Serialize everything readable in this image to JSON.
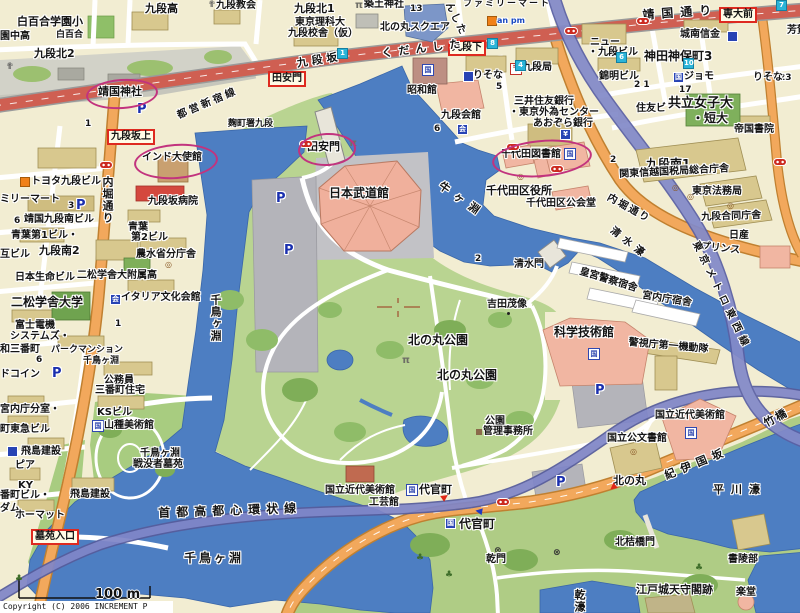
{
  "meta": {
    "copyright": "Copyright (C) 2006 INCREMENT P CORP.",
    "scale_label": "100 m"
  },
  "colors": {
    "water": "#4D7EC2",
    "park_green": "#B9D491",
    "dark_green": "#7FAE58",
    "block_cream": "#F2EDD2",
    "building_tan": "#D8C88E",
    "building_pink": "#F1B6A2",
    "building_red": "#D4483E",
    "road_orange": "#F2A85C",
    "road_red": "#CF5F52",
    "expressway_purple": "#8086C8",
    "annotation_magenta": "#C2337E",
    "station_box_red": "#DE2A20",
    "parking_blue": "#1A2FAE"
  },
  "map": {
    "annotations": [
      {
        "x": 86,
        "y": 79,
        "w": 68,
        "h": 26,
        "r": -4,
        "n": "annotation-yasukuni-shrine"
      },
      {
        "x": 134,
        "y": 144,
        "w": 80,
        "h": 31,
        "r": -4,
        "n": "annotation-india-embassy"
      },
      {
        "x": 298,
        "y": 133,
        "w": 54,
        "h": 29,
        "r": -3,
        "n": "annotation-tayasumon"
      },
      {
        "x": 492,
        "y": 140,
        "w": 96,
        "h": 33,
        "r": -5,
        "n": "annotation-chiyoda-library"
      }
    ],
    "labels": [
      {
        "t": "白百合学園小",
        "x": 17,
        "y": 16,
        "c": "s11"
      },
      {
        "t": "園中高",
        "x": 0,
        "y": 32
      },
      {
        "t": "白百合",
        "x": 56,
        "y": 31,
        "c": "s9"
      },
      {
        "t": "九段北2",
        "x": 34,
        "y": 48,
        "c": "s11"
      },
      {
        "t": "九段高",
        "x": 145,
        "y": 3,
        "c": "s11"
      },
      {
        "t": "✟",
        "x": 208,
        "y": 1,
        "c": "church"
      },
      {
        "t": "九段教会",
        "x": 216,
        "y": 1
      },
      {
        "t": "✟",
        "x": 6,
        "y": 63,
        "c": "church"
      },
      {
        "t": "九段北1",
        "x": 294,
        "y": 3,
        "c": "s11"
      },
      {
        "t": "π",
        "x": 355,
        "y": 1,
        "c": "torii"
      },
      {
        "t": "築土神社",
        "x": 364,
        "y": 0
      },
      {
        "t": "13",
        "x": 410,
        "y": 5,
        "c": "s9"
      },
      {
        "t": "東京理科大",
        "x": 295,
        "y": 18
      },
      {
        "t": "九段校舎（仮）",
        "x": 288,
        "y": 29
      },
      {
        "t": "北の丸スクエア",
        "x": 380,
        "y": 23
      },
      {
        "t": "ファミリーマート",
        "x": 463,
        "y": 0,
        "c": "s9",
        "ls": 2
      },
      {
        "t": "",
        "x": 487,
        "y": 16,
        "c": "sqo"
      },
      {
        "t": "an pm",
        "x": 497,
        "y": 17,
        "c": "ampm"
      },
      {
        "t": "靖国通り",
        "x": 642,
        "y": 9,
        "c": "s12",
        "ls": 7,
        "r": -4,
        "n": "yasukuni-dori-label"
      },
      {
        "t": "",
        "x": 637,
        "y": 18,
        "c": "bus"
      },
      {
        "t": "専大前",
        "x": 719,
        "y": 7,
        "c": "rbox",
        "n": "sendaimae-stop-box"
      },
      {
        "t": "芳賀",
        "x": 787,
        "y": 26
      },
      {
        "t": "城南信金",
        "x": 680,
        "y": 30
      },
      {
        "t": "",
        "x": 727,
        "y": 31,
        "c": "sqb"
      },
      {
        "t": "ニュー",
        "x": 590,
        "y": 38
      },
      {
        "t": "・九段ビル",
        "x": 588,
        "y": 48
      },
      {
        "t": "神田神保町3",
        "x": 644,
        "y": 50,
        "c": "s12"
      },
      {
        "t": "錦明ビル",
        "x": 599,
        "y": 72
      },
      {
        "t": "2 1",
        "x": 634,
        "y": 81,
        "c": "s9"
      },
      {
        "t": "国",
        "x": 673,
        "y": 72,
        "c": "sqb"
      },
      {
        "t": "ジョモ",
        "x": 684,
        "y": 72
      },
      {
        "t": "17",
        "x": 679,
        "y": 86,
        "c": "s9"
      },
      {
        "t": "23",
        "x": 779,
        "y": 74,
        "c": "s9"
      },
      {
        "t": "りそな",
        "x": 753,
        "y": 73
      },
      {
        "t": "住友ビ",
        "x": 636,
        "y": 104
      },
      {
        "t": "共立女子大",
        "x": 668,
        "y": 97,
        "c": "s13"
      },
      {
        "t": "・短大",
        "x": 692,
        "y": 112,
        "c": "s12"
      },
      {
        "t": "帝国書院",
        "x": 734,
        "y": 125
      },
      {
        "t": "九段南1",
        "x": 646,
        "y": 158,
        "c": "s12"
      },
      {
        "t": "2",
        "x": 610,
        "y": 156,
        "c": "s9"
      },
      {
        "t": "関東信越国税局総合庁舎",
        "x": 619,
        "y": 170,
        "r": -3
      },
      {
        "t": "東京法務局",
        "x": 692,
        "y": 187
      },
      {
        "t": "九段合同庁舎",
        "x": 701,
        "y": 213,
        "r": -2
      },
      {
        "t": "日産",
        "x": 729,
        "y": 231
      },
      {
        "t": "プリンス",
        "x": 701,
        "y": 242,
        "r": 6
      },
      {
        "t": "内堀通り",
        "x": 610,
        "y": 193,
        "r": 29,
        "ls": 2,
        "n": "uchibori-dori-label"
      },
      {
        "t": "清水濠",
        "x": 614,
        "y": 226,
        "r": 38,
        "ls": 5,
        "n": "shimizubori-label"
      },
      {
        "t": "東京メトロ東西線",
        "x": 699,
        "y": 240,
        "r": 64,
        "ls": 5,
        "n": "tozai-line-label"
      },
      {
        "t": "んした",
        "x": 452,
        "y": 1,
        "r": 64,
        "ls": 2
      },
      {
        "t": "九段下",
        "x": 448,
        "y": 40,
        "c": "rbox",
        "n": "kudanshita-box"
      },
      {
        "t": "くだんした",
        "x": 381,
        "y": 48,
        "c": "s11",
        "ls": 6,
        "r": -7
      },
      {
        "t": "九段坂",
        "x": 296,
        "y": 58,
        "c": "s11",
        "ls": 4,
        "r": -9,
        "n": "kudanzaka-label"
      },
      {
        "t": "都営新宿線",
        "x": 176,
        "y": 112,
        "ls": 3,
        "r": -23,
        "n": "toei-shinjuku-line-label"
      },
      {
        "t": "靖国神社",
        "x": 98,
        "y": 86,
        "c": "s11",
        "n": "yasukuni-shrine-label"
      },
      {
        "t": "P",
        "x": 137,
        "y": 103,
        "c": "p"
      },
      {
        "t": "1",
        "x": 85,
        "y": 120,
        "c": "s9"
      },
      {
        "t": "九段坂上",
        "x": 107,
        "y": 129,
        "c": "rbox",
        "n": "kudanzakaue-box"
      },
      {
        "t": "麹町署九段",
        "x": 228,
        "y": 120,
        "c": "s9"
      },
      {
        "t": "田安門",
        "x": 268,
        "y": 71,
        "c": "rbox",
        "n": "tayasumon-stop-box"
      },
      {
        "t": "インド大使館",
        "x": 142,
        "y": 153,
        "n": "india-embassy-label"
      },
      {
        "t": "",
        "x": 20,
        "y": 177,
        "c": "sqo"
      },
      {
        "t": "トヨタ九段ビル",
        "x": 31,
        "y": 177
      },
      {
        "t": "ミリーマート",
        "x": 0,
        "y": 195
      },
      {
        "t": "3",
        "x": 68,
        "y": 202,
        "c": "s9"
      },
      {
        "t": "P",
        "x": 76,
        "y": 199,
        "c": "p"
      },
      {
        "t": "6",
        "x": 14,
        "y": 217,
        "c": "s9"
      },
      {
        "t": "靖国九段南ビル",
        "x": 24,
        "y": 215
      },
      {
        "t": "青葉第1ビル・",
        "x": 11,
        "y": 231
      },
      {
        "t": "互ビル",
        "x": 0,
        "y": 250
      },
      {
        "t": "九段南2",
        "x": 39,
        "y": 245,
        "c": "s11"
      },
      {
        "t": "九段坂病院",
        "x": 148,
        "y": 197
      },
      {
        "t": "青葉",
        "x": 128,
        "y": 223
      },
      {
        "t": "第2ビル",
        "x": 131,
        "y": 233
      },
      {
        "t": "農水省分庁舎",
        "x": 136,
        "y": 250
      },
      {
        "t": "◎",
        "x": 165,
        "y": 261,
        "c": "gov"
      },
      {
        "t": "内堀通り",
        "x": 102,
        "y": 176,
        "c": "vert s11",
        "n": "uchibori-dori-west-label"
      },
      {
        "t": "日本生命ビル",
        "x": 15,
        "y": 273
      },
      {
        "t": "二松学舎大附属高",
        "x": 77,
        "y": 271
      },
      {
        "t": "二松学舎大学",
        "x": 11,
        "y": 296,
        "c": "s12"
      },
      {
        "t": "会",
        "x": 110,
        "y": 294,
        "c": "sqb"
      },
      {
        "t": "イタリア文化会館",
        "x": 121,
        "y": 293
      },
      {
        "t": "1",
        "x": 115,
        "y": 320,
        "c": "s9"
      },
      {
        "t": "富士電機",
        "x": 15,
        "y": 321
      },
      {
        "t": "システムズ・",
        "x": 10,
        "y": 332
      },
      {
        "t": "和三番町",
        "x": 0,
        "y": 345
      },
      {
        "t": "6",
        "x": 36,
        "y": 356,
        "c": "s9"
      },
      {
        "t": "パークマンション",
        "x": 51,
        "y": 346,
        "c": "s9"
      },
      {
        "t": "千鳥ヶ淵",
        "x": 83,
        "y": 357,
        "c": "s9"
      },
      {
        "t": "ドコイン",
        "x": 0,
        "y": 370
      },
      {
        "t": "P",
        "x": 52,
        "y": 367,
        "c": "p"
      },
      {
        "t": "公務員",
        "x": 104,
        "y": 376
      },
      {
        "t": "三番町住宅",
        "x": 95,
        "y": 386
      },
      {
        "t": "宮内庁分室・",
        "x": 0,
        "y": 405
      },
      {
        "t": "町東急ビル",
        "x": 0,
        "y": 425
      },
      {
        "t": "KSビル",
        "x": 97,
        "y": 408
      },
      {
        "t": "国",
        "x": 92,
        "y": 420,
        "c": "mus"
      },
      {
        "t": "山種美術館",
        "x": 104,
        "y": 421
      },
      {
        "t": "",
        "x": 7,
        "y": 446,
        "c": "sqb"
      },
      {
        "t": "飛島建設",
        "x": 21,
        "y": 447
      },
      {
        "t": "ピア",
        "x": 15,
        "y": 461
      },
      {
        "t": "千鳥ヶ淵",
        "x": 140,
        "y": 449
      },
      {
        "t": "戦没者墓苑",
        "x": 133,
        "y": 460
      },
      {
        "t": "KY",
        "x": 18,
        "y": 481
      },
      {
        "t": "番町ビル・",
        "x": 0,
        "y": 491
      },
      {
        "t": "ダム",
        "x": 0,
        "y": 504
      },
      {
        "t": "飛島建設",
        "x": 70,
        "y": 490
      },
      {
        "t": "ホーマット",
        "x": 15,
        "y": 511
      },
      {
        "t": "墓苑入口",
        "x": 31,
        "y": 529,
        "c": "rbox",
        "n": "cemetery-entrance-box"
      },
      {
        "t": "♣",
        "x": 15,
        "y": 575,
        "c": "tree"
      },
      {
        "t": "首都高都心環状線",
        "x": 158,
        "y": 507,
        "c": "s12",
        "ls": 6,
        "r": -2,
        "n": "shuto-expressway-label"
      },
      {
        "t": "千鳥ヶ淵",
        "x": 184,
        "y": 552,
        "c": "s12",
        "ls": 3,
        "n": "chidorigafuchi-label"
      },
      {
        "t": "千鳥ヶ淵",
        "x": 210,
        "y": 294,
        "c": "vert s11",
        "n": "chidorigafuchi-moat-label"
      },
      {
        "t": "π",
        "x": 349,
        "y": 139,
        "c": "torii"
      },
      {
        "t": "田安門",
        "x": 307,
        "y": 141,
        "c": "s11",
        "n": "tayasumon-label"
      },
      {
        "t": "日本武道館",
        "x": 329,
        "y": 187,
        "c": "s12",
        "n": "budokan-label"
      },
      {
        "t": "P",
        "x": 276,
        "y": 192,
        "c": "p"
      },
      {
        "t": "P",
        "x": 284,
        "y": 244,
        "c": "p"
      },
      {
        "t": "昭和館",
        "x": 407,
        "y": 86
      },
      {
        "t": "国",
        "x": 422,
        "y": 64,
        "c": "mus"
      },
      {
        "t": "九段会館",
        "x": 441,
        "y": 111
      },
      {
        "t": "6",
        "x": 434,
        "y": 125,
        "c": "s9"
      },
      {
        "t": "会",
        "x": 457,
        "y": 124,
        "c": "sqb"
      },
      {
        "t": "りそな",
        "x": 473,
        "y": 71
      },
      {
        "t": "",
        "x": 463,
        "y": 71,
        "c": "sqb"
      },
      {
        "t": "5",
        "x": 496,
        "y": 83,
        "c": "s9"
      },
      {
        "t": "〒",
        "x": 510,
        "y": 63,
        "c": "post"
      },
      {
        "t": "九段局",
        "x": 522,
        "y": 63
      },
      {
        "t": "三井住友銀行",
        "x": 514,
        "y": 97
      },
      {
        "t": "・東京外為センター",
        "x": 509,
        "y": 108
      },
      {
        "t": "あおぞら銀行",
        "x": 533,
        "y": 119
      },
      {
        "t": "¥",
        "x": 560,
        "y": 129,
        "c": "sqb"
      },
      {
        "t": "千代田図書館",
        "x": 501,
        "y": 150,
        "n": "chiyoda-library-label"
      },
      {
        "t": "国",
        "x": 564,
        "y": 148,
        "c": "mus"
      },
      {
        "t": "◎",
        "x": 517,
        "y": 173,
        "c": "gov"
      },
      {
        "t": "千代田区役所",
        "x": 486,
        "y": 185,
        "c": "s11",
        "n": "chiyoda-ward-office-label"
      },
      {
        "t": "千代田区公会堂",
        "x": 526,
        "y": 199
      },
      {
        "t": "牛ヶ淵",
        "x": 443,
        "y": 180,
        "c": "s11",
        "ls": 7,
        "r": 35,
        "n": "ushigafuchi-label"
      },
      {
        "t": "清水門",
        "x": 514,
        "y": 260,
        "n": "shimizumon-label"
      },
      {
        "t": "2",
        "x": 475,
        "y": 255,
        "c": "s9"
      },
      {
        "t": "皇宮警察宿舎",
        "x": 581,
        "y": 267,
        "r": 17
      },
      {
        "t": "宮内庁宿舎",
        "x": 643,
        "y": 291,
        "r": 9
      },
      {
        "t": "警視庁第一機動隊",
        "x": 629,
        "y": 338,
        "r": 5
      },
      {
        "t": "吉田茂像",
        "x": 487,
        "y": 300
      },
      {
        "t": "",
        "x": 507,
        "y": 312,
        "c": "dotb"
      },
      {
        "t": "北の丸公園",
        "x": 408,
        "y": 334,
        "c": "s12",
        "n": "kitanomaru-park-label"
      },
      {
        "t": "北の丸公園",
        "x": 437,
        "y": 369,
        "c": "s12",
        "n": "kitanomaru-park-label-2"
      },
      {
        "t": "π",
        "x": 402,
        "y": 356,
        "c": "torii"
      },
      {
        "t": "科学技術館",
        "x": 554,
        "y": 326,
        "c": "s12",
        "n": "science-museum-label"
      },
      {
        "t": "国",
        "x": 588,
        "y": 348,
        "c": "mus"
      },
      {
        "t": "P",
        "x": 595,
        "y": 384,
        "c": "p"
      },
      {
        "t": "公園",
        "x": 485,
        "y": 417
      },
      {
        "t": "管理事務所",
        "x": 483,
        "y": 427
      },
      {
        "t": "",
        "x": 476,
        "y": 429,
        "c": "hut"
      },
      {
        "t": "国立近代美術館",
        "x": 325,
        "y": 486
      },
      {
        "t": "工芸館",
        "x": 369,
        "y": 498
      },
      {
        "t": "国",
        "x": 406,
        "y": 484,
        "c": "mus"
      },
      {
        "t": "代官町",
        "x": 419,
        "y": 484,
        "c": "s11"
      },
      {
        "t": "▶",
        "x": 440,
        "y": 496,
        "c": "arrR",
        "r": -35
      },
      {
        "t": "◀",
        "x": 476,
        "y": 507,
        "c": "arrB",
        "r": 10
      },
      {
        "t": "国",
        "x": 445,
        "y": 518,
        "c": "sqb"
      },
      {
        "t": "代官町",
        "x": 459,
        "y": 518,
        "c": "s12",
        "n": "daikancho-label"
      },
      {
        "t": "⊗",
        "x": 494,
        "y": 547,
        "c": "x"
      },
      {
        "t": "乾門",
        "x": 486,
        "y": 555,
        "n": "inuimon-label"
      },
      {
        "t": "⊗",
        "x": 553,
        "y": 549,
        "c": "x"
      },
      {
        "t": "♣",
        "x": 416,
        "y": 554,
        "c": "tree"
      },
      {
        "t": "♣",
        "x": 445,
        "y": 571,
        "c": "tree"
      },
      {
        "t": "♣",
        "x": 695,
        "y": 564,
        "c": "tree"
      },
      {
        "t": "P",
        "x": 556,
        "y": 476,
        "c": "p"
      },
      {
        "t": "国立近代美術館",
        "x": 655,
        "y": 411,
        "n": "momat-label"
      },
      {
        "t": "国",
        "x": 685,
        "y": 427,
        "c": "mus"
      },
      {
        "t": "国立公文書館",
        "x": 607,
        "y": 434,
        "n": "national-archives-label"
      },
      {
        "t": "◎",
        "x": 630,
        "y": 448,
        "c": "gov"
      },
      {
        "t": "北の丸",
        "x": 613,
        "y": 475,
        "c": "s11",
        "n": "kitanomaru-stop-label"
      },
      {
        "t": "▶",
        "x": 618,
        "y": 488,
        "c": "arrR",
        "r": 140
      },
      {
        "t": "紀伊国坂",
        "x": 663,
        "y": 471,
        "c": "s11",
        "ls": 6,
        "r": -22,
        "n": "kiinokunizaka-label"
      },
      {
        "t": "竹橋",
        "x": 762,
        "y": 419,
        "c": "s11",
        "ls": 2,
        "r": -28,
        "n": "takebashi-label"
      },
      {
        "t": "平川濠",
        "x": 713,
        "y": 484,
        "c": "s11",
        "ls": 7,
        "n": "hirakawabori-label"
      },
      {
        "t": "北桔橋門",
        "x": 615,
        "y": 538,
        "n": "kitahanebashimon-label"
      },
      {
        "t": "書陵部",
        "x": 728,
        "y": 555
      },
      {
        "t": "江戸城天守閣跡",
        "x": 636,
        "y": 584,
        "c": "s11",
        "n": "edo-castle-keep-label"
      },
      {
        "t": "楽堂",
        "x": 736,
        "y": 588
      },
      {
        "t": "乾濠",
        "x": 574,
        "y": 589,
        "c": "vert s11",
        "n": "inuibori-label"
      },
      {
        "t": "◎",
        "x": 672,
        "y": 184,
        "c": "gov"
      },
      {
        "t": "◎",
        "x": 687,
        "y": 193,
        "c": "gov"
      },
      {
        "t": "◎",
        "x": 727,
        "y": 202,
        "c": "gov"
      },
      {
        "t": "",
        "x": 300,
        "y": 141,
        "c": "bus"
      },
      {
        "t": "",
        "x": 100,
        "y": 162,
        "c": "bus"
      },
      {
        "t": "",
        "x": 565,
        "y": 28,
        "c": "bus"
      },
      {
        "t": "",
        "x": 507,
        "y": 144,
        "c": "bus"
      },
      {
        "t": "",
        "x": 551,
        "y": 166,
        "c": "bus"
      },
      {
        "t": "",
        "x": 774,
        "y": 159,
        "c": "bus"
      },
      {
        "t": "",
        "x": 497,
        "y": 499,
        "c": "bus"
      },
      {
        "t": "1",
        "x": 337,
        "y": 48,
        "c": "exit"
      },
      {
        "t": "8",
        "x": 487,
        "y": 38,
        "c": "exit"
      },
      {
        "t": "4",
        "x": 515,
        "y": 60,
        "c": "exit"
      },
      {
        "t": "6",
        "x": 616,
        "y": 52,
        "c": "exit"
      },
      {
        "t": "10",
        "x": 683,
        "y": 58,
        "c": "exit"
      },
      {
        "t": "7",
        "x": 776,
        "y": 0,
        "c": "exit"
      }
    ]
  }
}
